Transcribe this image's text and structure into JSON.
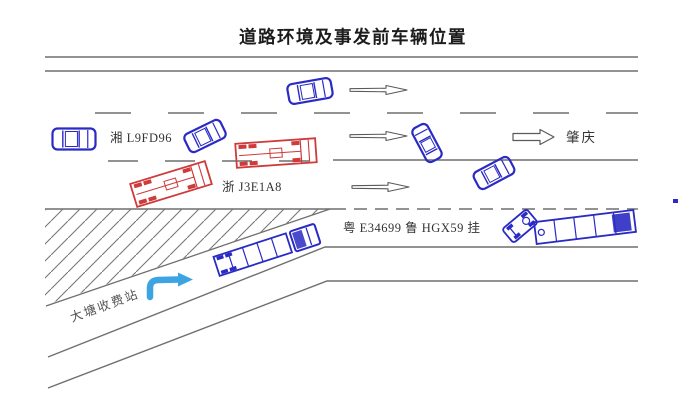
{
  "title": "道路环境及事发前车辆位置",
  "labels": {
    "plate_xiang": "湘 L9FD96",
    "plate_zhe": "浙 J3E1A8",
    "plate_yue_lu": "粤 E34699 鲁 HGX59 挂",
    "destination": "肇庆",
    "toll_station": "大塘收费站"
  },
  "colors": {
    "vehicle_blue": "#2a2ac4",
    "vehicle_red": "#cf3a3a",
    "road_line": "#6f6f6f",
    "arrow_outline": "#5a5a5a",
    "merge_arrow_blue": "#3da4e4",
    "text_dark": "#333333",
    "toll_text": "#555555",
    "title_color": "#1c1c1c"
  },
  "vehicles": [
    {
      "id": "car-top-lane",
      "kind": "car",
      "color": "vehicle_blue",
      "x": 310,
      "y": 91,
      "rot": -10,
      "l": 44,
      "w": 20
    },
    {
      "id": "car-xiang-plate",
      "kind": "car",
      "color": "vehicle_blue",
      "x": 74,
      "y": 139,
      "rot": 0,
      "l": 43,
      "w": 21
    },
    {
      "id": "car-middle-skewed",
      "kind": "car",
      "color": "vehicle_blue",
      "x": 205,
      "y": 136,
      "rot": -26,
      "l": 40,
      "w": 20
    },
    {
      "id": "car-turned-up",
      "kind": "car",
      "color": "vehicle_blue",
      "x": 427,
      "y": 143,
      "rot": -118,
      "l": 38,
      "w": 17
    },
    {
      "id": "car-diagonal",
      "kind": "car",
      "color": "vehicle_blue",
      "x": 494,
      "y": 173,
      "rot": -28,
      "l": 40,
      "w": 19
    },
    {
      "id": "truck-zhe-right",
      "kind": "flatbed",
      "color": "vehicle_red",
      "x": 276,
      "y": 153,
      "rot": -4,
      "l": 80,
      "w": 24
    },
    {
      "id": "truck-zhe-left",
      "kind": "flatbed",
      "color": "vehicle_red",
      "x": 171,
      "y": 184,
      "rot": -17,
      "l": 78,
      "w": 24
    },
    {
      "id": "semi-on-ramp",
      "kind": "semi",
      "color": "vehicle_blue",
      "x": 267,
      "y": 250,
      "rot": -18,
      "l": 106,
      "w": 21
    },
    {
      "id": "trailer-lu-plate",
      "kind": "trailer",
      "color": "vehicle_blue",
      "x": 585,
      "y": 227,
      "rot": -7,
      "l": 100,
      "w": 22
    },
    {
      "id": "tractor-yue-plate",
      "kind": "tractor",
      "color": "vehicle_blue",
      "x": 520,
      "y": 226,
      "rot": 140,
      "l": 32,
      "w": 18
    }
  ],
  "lane_arrows": [
    {
      "x": 350,
      "y": 90
    },
    {
      "x": 350,
      "y": 136
    },
    {
      "x": 352,
      "y": 187
    }
  ],
  "exit_arrow": {
    "x": 513,
    "y": 137
  }
}
